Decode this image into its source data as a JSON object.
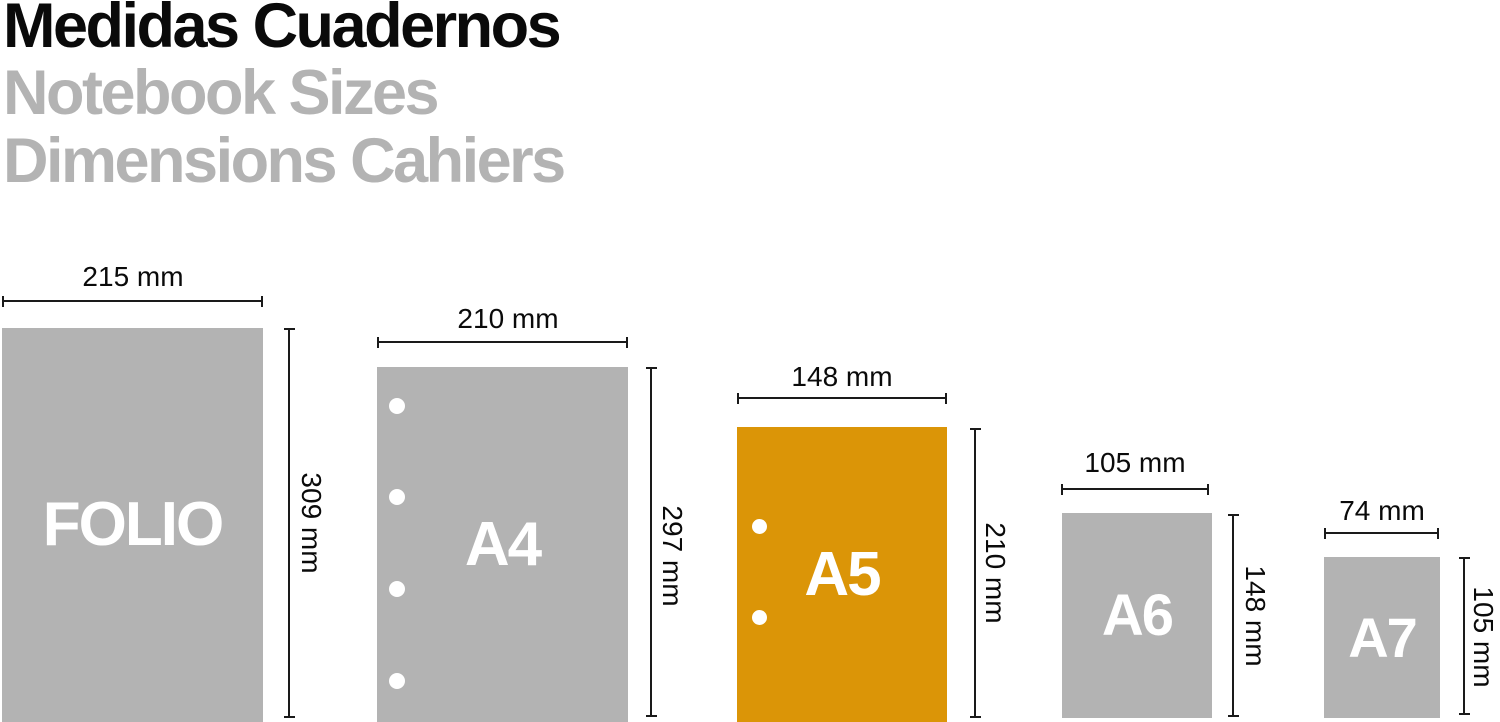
{
  "title": {
    "line_es": "Medidas Cuadernos",
    "line_en": "Notebook Sizes",
    "line_fr": "Dimensions Cahiers"
  },
  "colors": {
    "title_black": "#0a0a0a",
    "soft_gray": "#b3b3b3",
    "accent_orange": "#db9507",
    "line_dark": "#1a1a1a",
    "label_white": "#ffffff"
  },
  "papers": [
    {
      "id": "folio",
      "name": "FOLIO",
      "width_label": "215 mm",
      "height_label": "309 mm",
      "width_mm": 215,
      "height_mm": 309,
      "holes": 0,
      "highlighted": false
    },
    {
      "id": "a4",
      "name": "A4",
      "width_label": "210 mm",
      "height_label": "297 mm",
      "width_mm": 210,
      "height_mm": 297,
      "holes": 4,
      "highlighted": false
    },
    {
      "id": "a5",
      "name": "A5",
      "width_label": "148 mm",
      "height_label": "210 mm",
      "width_mm": 148,
      "height_mm": 210,
      "holes": 2,
      "highlighted": true
    },
    {
      "id": "a6",
      "name": "A6",
      "width_label": "105 mm",
      "height_label": "148 mm",
      "width_mm": 105,
      "height_mm": 148,
      "holes": 0,
      "highlighted": false
    },
    {
      "id": "a7",
      "name": "A7",
      "width_label": "74 mm",
      "height_label": "105 mm",
      "width_mm": 74,
      "height_mm": 105,
      "holes": 0,
      "highlighted": false
    }
  ]
}
